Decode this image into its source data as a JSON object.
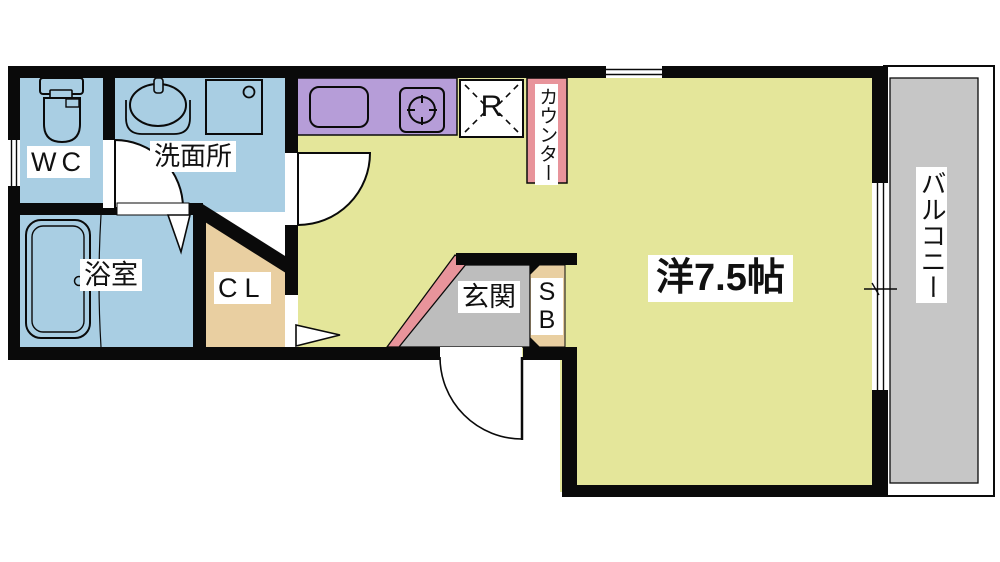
{
  "figure": {
    "type": "apartment-floor-plan"
  },
  "colors": {
    "wall": "#0a0a0a",
    "water_rooms": "#a9cee3",
    "kitchen_counter": "#b69dd8",
    "accent_pink": "#e8949b",
    "storage_tan": "#e9cfa1",
    "main_room": "#e4e69a",
    "entrance_gray": "#bdbdbd",
    "balcony_gray": "#c6c6c6",
    "white": "#ffffff"
  },
  "rooms": {
    "wc": {
      "label": "WC"
    },
    "washroom": {
      "label": "洗面所"
    },
    "bathroom": {
      "label": "浴室"
    },
    "closet": {
      "label": "CL"
    },
    "kitchen_counter": {
      "label": "カウンター"
    },
    "refrigerator": {
      "label": "R"
    },
    "entrance": {
      "label": "玄関"
    },
    "shoe_box": {
      "label": "SB"
    },
    "main_room": {
      "label": "洋7.5帖"
    },
    "balcony": {
      "label": "バルコニー"
    }
  }
}
